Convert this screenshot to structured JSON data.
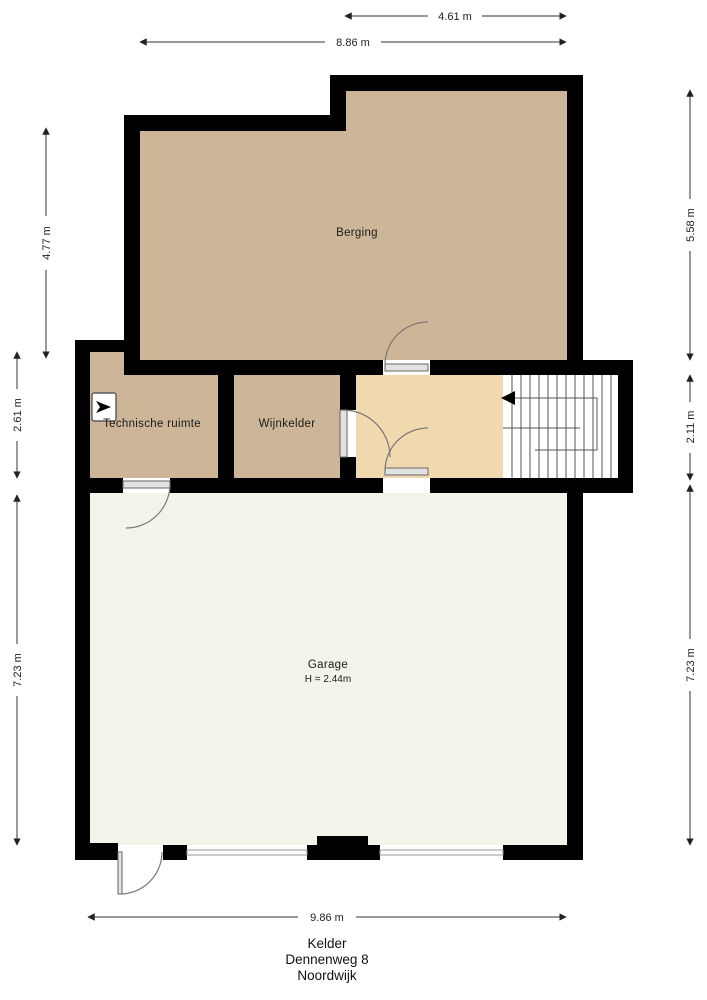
{
  "title": {
    "line1": "Kelder",
    "line2": "Dennenweg 8",
    "line3": "Noordwijk"
  },
  "rooms": {
    "berging": {
      "label": "Berging"
    },
    "technische_ruimte": {
      "label": "Technische ruimte"
    },
    "wijnkelder": {
      "label": "Wijnkelder"
    },
    "garage": {
      "label": "Garage",
      "height": "H = 2.44m"
    }
  },
  "dimensions": {
    "top_inner": "4.61 m",
    "top_outer": "8.86 m",
    "left_upper": "4.77 m",
    "left_middle": "2.61 m",
    "left_lower": "7.23 m",
    "right_upper": "5.58 m",
    "right_middle": "2.11 m",
    "right_lower": "7.23 m",
    "bottom": "9.86 m"
  },
  "colors": {
    "wall": "#000000",
    "storage": "#cdb697",
    "hallway": "#f0d9ae",
    "garage": "#f4f3ea",
    "stairwell": "#ffffff",
    "background": "#ffffff"
  },
  "icons": {
    "stair_direction_arrow": "left-arrow",
    "ventilation_unit": "mv-box-arrow"
  }
}
